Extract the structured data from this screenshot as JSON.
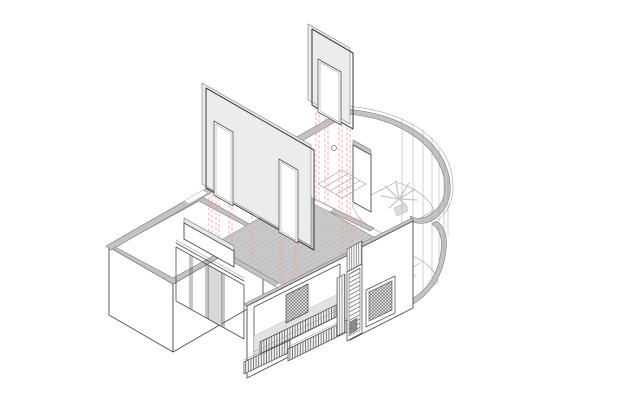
{
  "canvas": {
    "width": 618,
    "height": 412
  },
  "scene": {
    "type": "architectural-axonometric-line-drawing",
    "elements": [
      "floating tiled partition wall with two door openings",
      "floating tiled partition wall with one door opening",
      "red dashed projection lines dropping to plan",
      "apartment plan with grey wall poche",
      "hatched main room floor",
      "glazed interior partition with sliding panel",
      "curved glazed bay on two levels with plants",
      "street facade with grille window, louvred door, radiator and benches",
      "tall service box volume at west corner",
      "stair flight in rear room"
    ]
  },
  "colors": {
    "background": "#ffffff",
    "line": "#4b4b4b",
    "wall_fill": "#c3c3c3",
    "wall_gap": "#ffffff",
    "floor_fill": "#c9c9c9",
    "floor_hatch": "#b5b5b5",
    "bay_floor_fill": "#d8d8d8",
    "bay_floor_grid": "#c8c8c8",
    "panel_face": "#ffffff",
    "panel_tile_grid": "#d3d3d3",
    "panel_edge_fill": "#ececec",
    "glass_panel_shade": "#d9d9d9",
    "projection_red": "#ef9f9f",
    "grille_dark": "#3f3f3f",
    "fin_stroke": "#4a4a4a",
    "fin_bg": "#f2f2f2",
    "plant_stroke": "#c3c9c3",
    "plant_stroke_faint": "#ccd1cc",
    "interior_floor": "#e2e2e2",
    "top_white": "#fdfdfd"
  }
}
